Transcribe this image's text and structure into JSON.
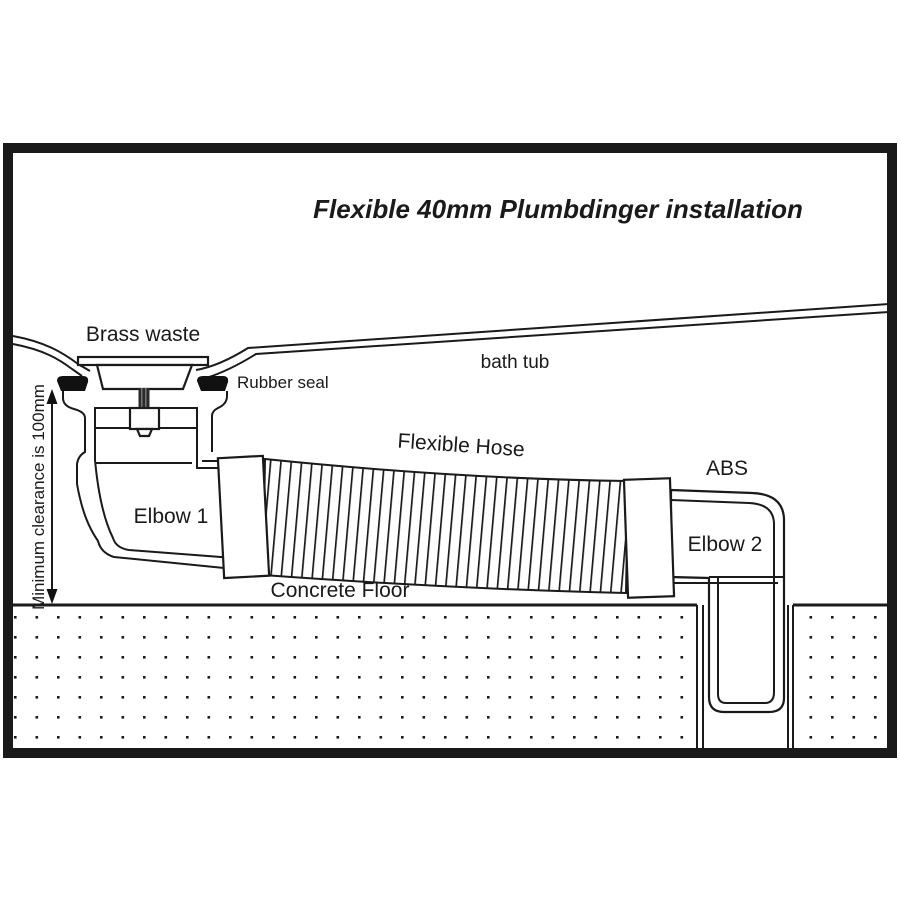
{
  "diagram": {
    "title": "Flexible 40mm Plumbdinger installation",
    "labels": {
      "brass_waste": "Brass waste",
      "rubber_seal": "Rubber seal",
      "bath_tub": "bath tub",
      "flexible_hose": "Flexible Hose",
      "abs": "ABS",
      "elbow_1": "Elbow 1",
      "elbow_2": "Elbow 2",
      "concrete_floor": "Concrete Floor",
      "min_clearance": "Minimum clearance is 100mm"
    },
    "colors": {
      "line": "#1a1a1a",
      "background": "#ffffff"
    }
  }
}
